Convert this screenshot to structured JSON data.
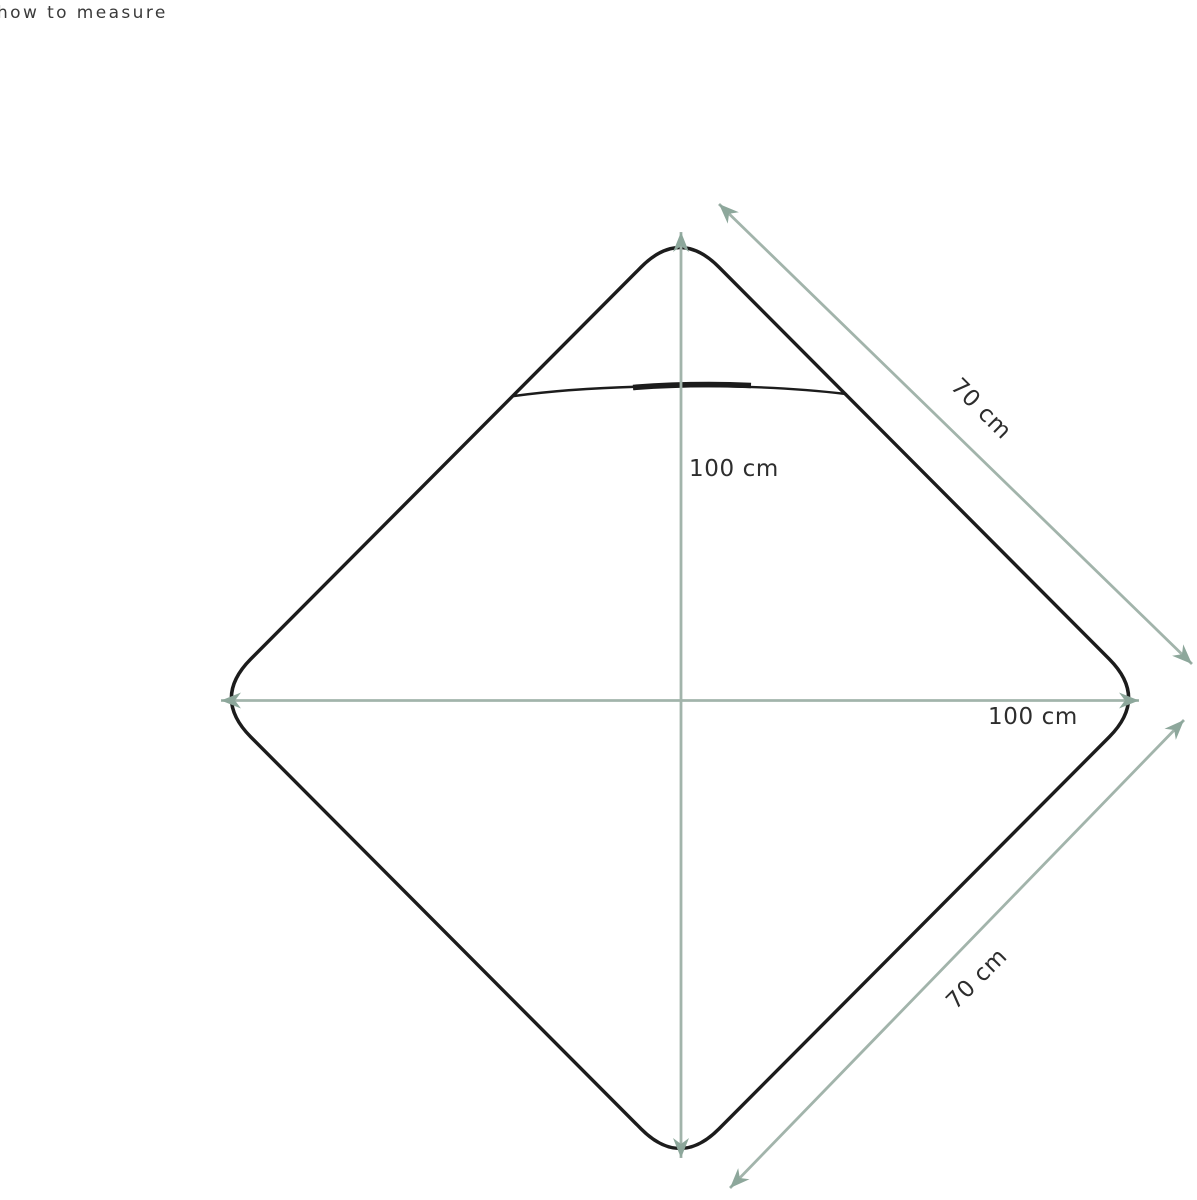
{
  "page": {
    "title": "how to measure"
  },
  "colors": {
    "background": "#ffffff",
    "outline": "#1c1c1c",
    "arrow_line": "#a2b4ab",
    "arrow_head": "#8da79b",
    "label_text": "#2d2d2d",
    "title_text": "#3a3a3a"
  },
  "figure": {
    "description": "rounded-corner diamond (point-up square) blanket outline with a curved hood seam near the top point",
    "measurements": {
      "vertical": {
        "label": "100 cm",
        "axis": "top point to bottom point"
      },
      "horizontal": {
        "label": "100 cm",
        "axis": "left point to right point"
      },
      "diagonal_top": {
        "label": "70 cm",
        "axis": "upper-right edge"
      },
      "diagonal_bottom": {
        "label": "70 cm",
        "axis": "lower-right edge"
      }
    }
  }
}
